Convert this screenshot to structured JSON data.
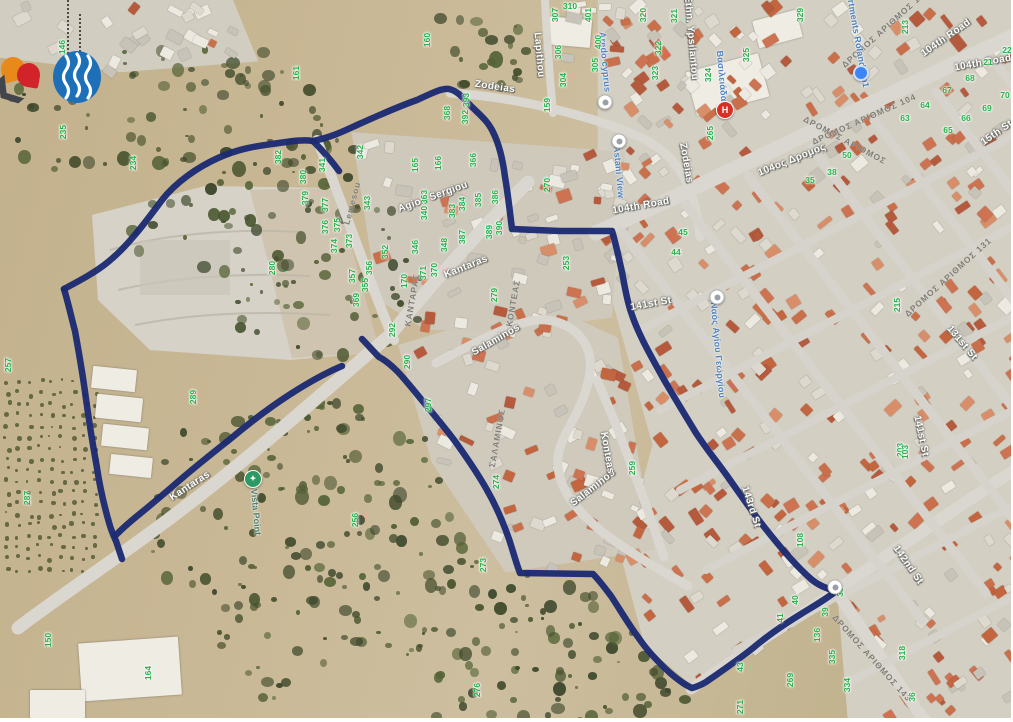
{
  "map": {
    "description": "Aerial satellite map with hand-drawn navy site boundary, Agios Athanasios / Limassol area",
    "boundary_color": "#1c2b72",
    "parcel_number_color": "#27b14b",
    "boundary_paths": [
      "M 313 141 C 322 150 331 160 339 171",
      "M 64 289 C 79 281 96 272 108 262 C 129 245 147 220 162 200 C 176 182 198 167 218 158 C 240 148 258 146 272 144 C 287 142 301 139 313 141 C 332 137 344 131 357 125 C 377 116 397 107 417 100 C 430 94 441 88 449 89 C 458 91 464 99 471 106 C 479 114 488 121 493 132 C 499 144 503 161 505 177 C 508 194 510 213 512 229 L 560 231 L 612 231 C 616 244 619 259 622 272 C 625 288 627 301 631 312 C 638 334 651 356 663 378 C 674 397 685 415 696 433 C 707 450 719 464 730 480 C 742 497 753 513 765 528 C 780 547 796 566 811 579 C 819 586 828 589 836 591 C 828 598 814 606 801 614 C 783 625 766 637 753 648 C 738 660 719 673 706 682 C 701 685 696 687 692 688 C 685 685 677 679 669 672 C 656 660 646 649 638 637 C 629 625 619 608 611 596 C 605 588 599 580 593 574 L 520 573 C 516 563 513 551 509 539 C 503 522 495 504 487 490 C 478 474 467 458 457 444 C 447 430 435 416 425 404 C 415 392 405 379 397 371 C 391 365 385 360 379 357 C 373 351 367 344 362 339",
      "M 64 289 C 68 302 71 316 75 331 C 79 353 83 376 86 399 C 89 421 93 446 97 468 C 100 488 105 509 110 526 C 112 532 114 537 116 541 C 118 547 120 553 122 559",
      "M 342 366 C 323 374 306 384 289 395 C 269 408 248 424 229 440 C 210 455 190 471 173 486 C 158 499 142 512 130 522 C 124 527 119 532 115 536"
    ],
    "street_labels": [
      {
        "text": "Zodeias",
        "x": 495,
        "y": 87,
        "rot": 8,
        "style": "white"
      },
      {
        "text": "Zodeias",
        "x": 686,
        "y": 163,
        "rot": 80,
        "style": "white"
      },
      {
        "text": "Lapithou",
        "x": 539,
        "y": 55,
        "rot": 85,
        "style": "white"
      },
      {
        "text": "Agiou Sergiou",
        "x": 433,
        "y": 197,
        "rot": -20,
        "style": "white"
      },
      {
        "text": "Ethn. Ypsilantou",
        "x": 691,
        "y": 38,
        "rot": 85,
        "style": "white"
      },
      {
        "text": "104th Road",
        "x": 641,
        "y": 206,
        "rot": -10,
        "style": "white"
      },
      {
        "text": "104th Road",
        "x": 946,
        "y": 38,
        "rot": -35,
        "style": "white"
      },
      {
        "text": "104th Road",
        "x": 983,
        "y": 63,
        "rot": -10,
        "style": "white"
      },
      {
        "text": "104ος Δρομος",
        "x": 792,
        "y": 160,
        "rot": -22,
        "style": "white"
      },
      {
        "text": "141st St",
        "x": 651,
        "y": 304,
        "rot": -10,
        "style": "white"
      },
      {
        "text": "141st St",
        "x": 921,
        "y": 436,
        "rot": 78,
        "style": "white"
      },
      {
        "text": "131st St",
        "x": 962,
        "y": 343,
        "rot": 50,
        "style": "white"
      },
      {
        "text": "143rd St",
        "x": 751,
        "y": 507,
        "rot": 72,
        "style": "white"
      },
      {
        "text": "142nd St",
        "x": 908,
        "y": 565,
        "rot": 55,
        "style": "white"
      },
      {
        "text": "15th St",
        "x": 997,
        "y": 133,
        "rot": -35,
        "style": "white"
      },
      {
        "text": "Kantaras",
        "x": 466,
        "y": 267,
        "rot": -22,
        "style": "white"
      },
      {
        "text": "Kantaras",
        "x": 190,
        "y": 486,
        "rot": -33,
        "style": "white"
      },
      {
        "text": "Salaminos",
        "x": 496,
        "y": 340,
        "rot": -30,
        "style": "white"
      },
      {
        "text": "Salaminos",
        "x": 593,
        "y": 488,
        "rot": -38,
        "style": "white"
      },
      {
        "text": "Konteas",
        "x": 607,
        "y": 453,
        "rot": 80,
        "style": "white"
      },
      {
        "text": "ΚΑΝΤΑΡΑΣ",
        "x": 412,
        "y": 300,
        "rot": -80,
        "style": "grey"
      },
      {
        "text": "ΣΑΛΑΜΙΝΟΣ",
        "x": 497,
        "y": 438,
        "rot": -80,
        "style": "grey"
      },
      {
        "text": "ΚΟΝΤΕΑΣ",
        "x": 513,
        "y": 303,
        "rot": -80,
        "style": "grey"
      },
      {
        "text": "Lemesou",
        "x": 352,
        "y": 203,
        "rot": -75,
        "style": "grey"
      },
      {
        "text": "ΔΡΟΜΟΣ ΑΡΙΘΜΟΣ 137",
        "x": 885,
        "y": 28,
        "rot": -42,
        "style": "grey"
      },
      {
        "text": "ΔΡΟΜΟΣ ΑΡΙΘΜΟΣ 104",
        "x": 864,
        "y": 119,
        "rot": -24,
        "style": "grey"
      },
      {
        "text": "ΔΡΟΜΟΣ ΑΡΙΘΜΟΣ",
        "x": 845,
        "y": 140,
        "rot": 28,
        "style": "grey"
      },
      {
        "text": "ΔΡΟΜΟΣ ΑΡΙΘΜΟΣ 131",
        "x": 948,
        "y": 277,
        "rot": -42,
        "style": "grey"
      },
      {
        "text": "ΔΡΟΜΟΣ ΑΡΙΘΜΟΣ 143",
        "x": 872,
        "y": 658,
        "rot": 48,
        "style": "grey"
      },
      {
        "text": "Vista Point",
        "x": 256,
        "y": 512,
        "rot": 85,
        "style": "poi"
      },
      {
        "text": "Aredo cyprus",
        "x": 605,
        "y": 62,
        "rot": 85,
        "style": "blue"
      },
      {
        "text": "Astani View",
        "x": 619,
        "y": 172,
        "rot": 85,
        "style": "blue"
      },
      {
        "text": "Ναός Αγίου Γεωργίου",
        "x": 718,
        "y": 350,
        "rot": 85,
        "style": "blue"
      },
      {
        "text": "Apartments Roland No1",
        "x": 857,
        "y": 35,
        "rot": 80,
        "style": "blue"
      },
      {
        "text": "Βασιλειάδα",
        "x": 722,
        "y": 76,
        "rot": 85,
        "style": "blue"
      }
    ],
    "parcel_numbers": [
      [
        146,
        62,
        47,
        -90
      ],
      [
        235,
        63,
        132,
        -90
      ],
      [
        161,
        296,
        73,
        -90
      ],
      [
        160,
        427,
        40,
        -90
      ],
      [
        234,
        133,
        163,
        -90
      ],
      [
        257,
        8,
        365,
        -90
      ],
      [
        287,
        27,
        498,
        -90
      ],
      [
        289,
        193,
        397,
        -90
      ],
      [
        256,
        355,
        520,
        -90
      ],
      [
        150,
        48,
        640,
        -90
      ],
      [
        164,
        148,
        673,
        -90
      ],
      [
        280,
        272,
        268,
        -90
      ],
      [
        382,
        278,
        157,
        -90
      ],
      [
        341,
        322,
        165,
        -90
      ],
      [
        342,
        360,
        152,
        -90
      ],
      [
        380,
        303,
        177,
        -90
      ],
      [
        379,
        305,
        198,
        -90
      ],
      [
        377,
        325,
        205,
        -90
      ],
      [
        376,
        325,
        227,
        -90
      ],
      [
        375,
        337,
        225,
        -90
      ],
      [
        374,
        334,
        246,
        -90
      ],
      [
        373,
        349,
        241,
        -90
      ],
      [
        343,
        367,
        203,
        -90
      ],
      [
        357,
        352,
        276,
        -90
      ],
      [
        356,
        369,
        268,
        -90
      ],
      [
        355,
        365,
        285,
        -90
      ],
      [
        352,
        385,
        252,
        -90
      ],
      [
        369,
        356,
        300,
        -90
      ],
      [
        348,
        444,
        245,
        -90
      ],
      [
        292,
        392,
        330,
        -90
      ],
      [
        290,
        407,
        362,
        -90
      ],
      [
        297,
        428,
        405,
        -90
      ],
      [
        274,
        496,
        482,
        -90
      ],
      [
        259,
        632,
        468,
        -90
      ],
      [
        273,
        483,
        565,
        -90
      ],
      [
        276,
        477,
        690,
        -90
      ],
      [
        393,
        466,
        100,
        -90
      ],
      [
        392,
        465,
        117,
        -90
      ],
      [
        368,
        447,
        113,
        -90
      ],
      [
        307,
        555,
        15,
        -90
      ],
      [
        310,
        570,
        6,
        0
      ],
      [
        304,
        563,
        80,
        -90
      ],
      [
        306,
        558,
        52,
        -90
      ],
      [
        401,
        588,
        15,
        -90
      ],
      [
        400,
        598,
        42,
        -90
      ],
      [
        305,
        595,
        65,
        -90
      ],
      [
        159,
        547,
        105,
        -90
      ],
      [
        320,
        643,
        15,
        -90
      ],
      [
        321,
        674,
        16,
        -90
      ],
      [
        322,
        658,
        48,
        -90
      ],
      [
        323,
        655,
        73,
        -90
      ],
      [
        324,
        708,
        75,
        -90
      ],
      [
        325,
        746,
        55,
        -90
      ],
      [
        329,
        800,
        15,
        -90
      ],
      [
        265,
        710,
        133,
        -90
      ],
      [
        165,
        415,
        165,
        -90
      ],
      [
        166,
        438,
        163,
        -90
      ],
      [
        366,
        473,
        160,
        -90
      ],
      [
        363,
        424,
        197,
        -90
      ],
      [
        340,
        424,
        213,
        -90
      ],
      [
        384,
        462,
        204,
        -90
      ],
      [
        385,
        478,
        200,
        -90
      ],
      [
        386,
        495,
        197,
        -90
      ],
      [
        383,
        452,
        211,
        -90
      ],
      [
        346,
        415,
        247,
        -90
      ],
      [
        387,
        462,
        237,
        -90
      ],
      [
        389,
        489,
        232,
        -90
      ],
      [
        390,
        499,
        228,
        -90
      ],
      [
        371,
        423,
        273,
        -90
      ],
      [
        370,
        434,
        270,
        -90
      ],
      [
        170,
        404,
        281,
        -90
      ],
      [
        270,
        547,
        185,
        -90
      ],
      [
        253,
        566,
        263,
        -90
      ],
      [
        279,
        494,
        295,
        -90
      ],
      [
        213,
        905,
        27,
        -90
      ],
      [
        21,
        988,
        62,
        0
      ],
      [
        22,
        1007,
        50,
        0
      ],
      [
        68,
        970,
        78,
        0
      ],
      [
        67,
        947,
        90,
        0
      ],
      [
        64,
        925,
        105,
        0
      ],
      [
        63,
        905,
        118,
        0
      ],
      [
        66,
        966,
        118,
        0
      ],
      [
        69,
        987,
        108,
        0
      ],
      [
        70,
        1005,
        95,
        0
      ],
      [
        65,
        948,
        130,
        0
      ],
      [
        50,
        847,
        155,
        0
      ],
      [
        38,
        832,
        172,
        0
      ],
      [
        35,
        810,
        180,
        0
      ],
      [
        45,
        683,
        232,
        0
      ],
      [
        44,
        676,
        252,
        0
      ],
      [
        215,
        897,
        305,
        -90
      ],
      [
        203,
        900,
        450,
        -90
      ],
      [
        103,
        905,
        452,
        -90
      ],
      [
        108,
        800,
        540,
        -90
      ],
      [
        40,
        795,
        600,
        -90
      ],
      [
        41,
        780,
        618,
        -90
      ],
      [
        39,
        825,
        612,
        -90
      ],
      [
        38,
        840,
        592,
        -90
      ],
      [
        136,
        817,
        635,
        -90
      ],
      [
        335,
        832,
        657,
        -90
      ],
      [
        334,
        847,
        685,
        -90
      ],
      [
        43,
        740,
        667,
        -90
      ],
      [
        269,
        790,
        680,
        -90
      ],
      [
        271,
        740,
        707,
        -90
      ],
      [
        318,
        902,
        653,
        -90
      ],
      [
        36,
        912,
        697,
        -90
      ]
    ],
    "poi_markers": [
      {
        "name": "aredo-cyprus-marker",
        "type": "grey",
        "x": 605,
        "y": 102,
        "label": ""
      },
      {
        "name": "astani-view-marker",
        "type": "grey",
        "x": 619,
        "y": 141,
        "label": ""
      },
      {
        "name": "church-marker",
        "type": "grey",
        "x": 717,
        "y": 297,
        "label": ""
      },
      {
        "name": "junction-marker",
        "type": "grey",
        "x": 835,
        "y": 587,
        "label": ""
      },
      {
        "name": "business-marker",
        "type": "blue",
        "x": 861,
        "y": 73,
        "label": ""
      },
      {
        "name": "hospital-marker",
        "type": "red",
        "x": 725,
        "y": 110,
        "label": "H"
      },
      {
        "name": "vista-point-marker",
        "type": "green",
        "x": 253,
        "y": 479,
        "label": "✦"
      }
    ],
    "logos": [
      {
        "name": "water-board-limassol-logo",
        "x": 77,
        "y": 77,
        "color": "#1d6fb8"
      },
      {
        "name": "orange-petal-logo",
        "x": 13,
        "y": 69,
        "color": "#e8891c"
      },
      {
        "name": "red-petal-logo",
        "x": 28,
        "y": 75,
        "color": "#d2232a"
      },
      {
        "name": "dark-chevron-mark",
        "x": 10,
        "y": 95,
        "glyph": "❯",
        "color": "#43454d"
      }
    ]
  }
}
